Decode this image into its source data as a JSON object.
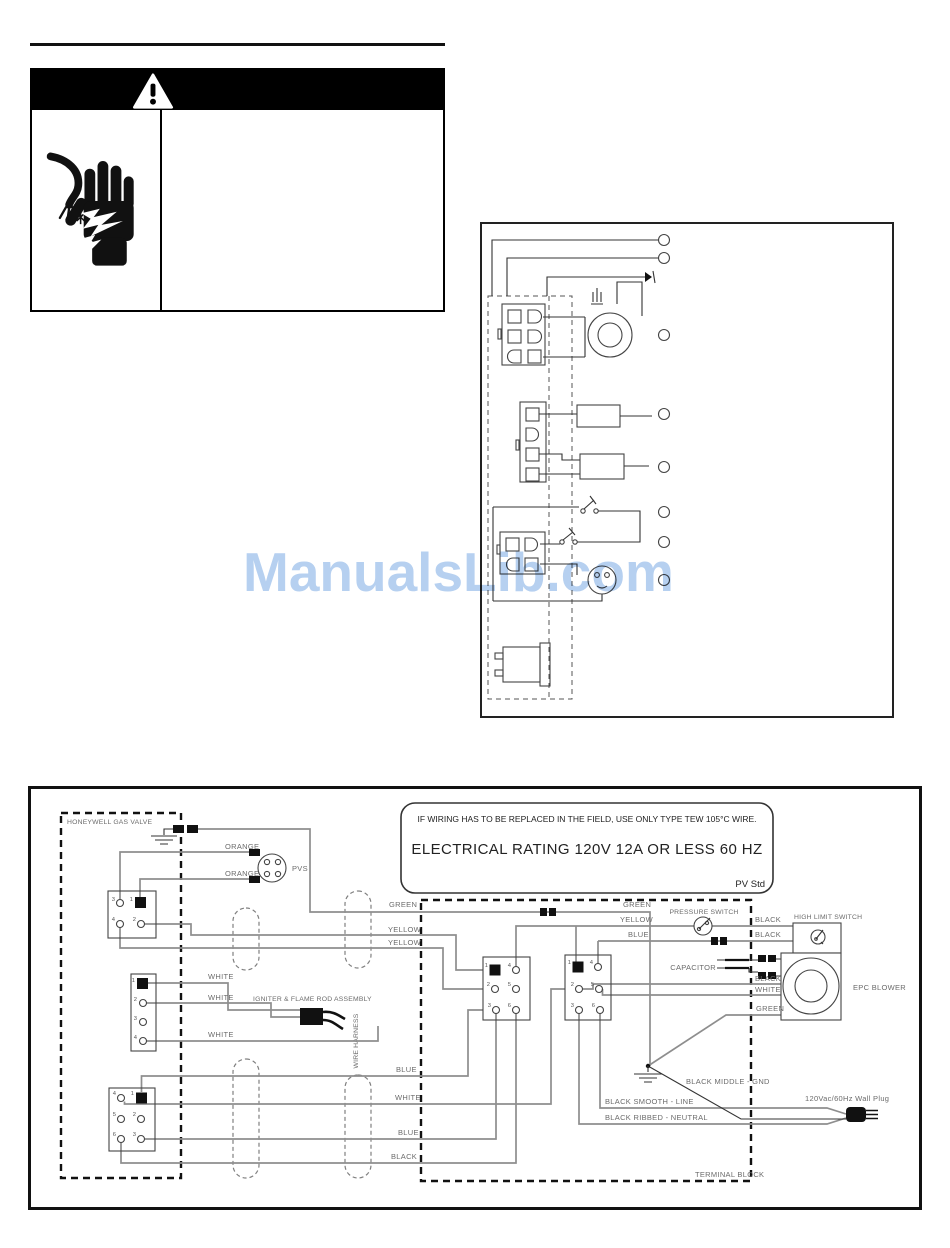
{
  "watermark": {
    "text": "ManualsLib.com",
    "color": "#b6d0f0"
  },
  "warning": {
    "header_icon": "warning-triangle",
    "left_icon": "electric-shock-hand"
  },
  "notice": {
    "line1": "IF WIRING HAS TO BE REPLACED IN THE FIELD, USE ONLY TYPE TEW 105°C WIRE.",
    "line2": "ELECTRICAL RATING 120V 12A OR LESS 60 HZ",
    "corner": "PV Std"
  },
  "labels": {
    "honeywell": "HONEYWELL GAS VALVE",
    "orange1": "ORANGE",
    "orange2": "ORANGE",
    "pvs": "PVS",
    "green_left": "GREEN",
    "yellow_left1": "YELLOW",
    "yellow_left2": "YELLOW",
    "green_tb": "GREEN",
    "yellow_tb": "YELLOW",
    "blue_tb": "BLUE",
    "pressure_switch": "PRESSURE SWITCH",
    "black_hl1": "BLACK",
    "black_hl2": "BLACK",
    "high_limit": "HIGH LIMIT SWITCH",
    "capacitor": "CAPACITOR",
    "black_blower": "BLACK",
    "white_blower": "WHITE",
    "green_blower": "GREEN",
    "epc_blower": "EPC BLOWER",
    "white1": "WHITE",
    "white2": "WHITE",
    "white3": "WHITE",
    "igniter": "IGNITER & FLAME ROD ASSEMBLY",
    "wire_harness": "WIRE HARNESS",
    "blue1": "BLUE",
    "white4": "WHITE",
    "blue2": "BLUE",
    "black4": "BLACK",
    "black_middle": "BLACK MIDDLE - GND",
    "black_smooth": "BLACK SMOOTH - LINE",
    "black_ribbed": "BLACK RIBBED - NEUTRAL",
    "wall_plug": "120Vac/60Hz Wall Plug",
    "terminal_block": "TERMINAL BLOCK"
  },
  "pins": {
    "gas_valve": [
      "3",
      "1",
      "4",
      "2"
    ],
    "igniter_conn": [
      "1",
      "2",
      "3",
      "4"
    ],
    "lower_left": [
      "4",
      "1",
      "5",
      "2",
      "6",
      "3"
    ],
    "tb_left": [
      "1",
      "4",
      "2",
      "5",
      "3",
      "6"
    ],
    "tb_right": [
      "1",
      "4",
      "2",
      "5",
      "3",
      "6"
    ]
  },
  "colors": {
    "watermark_blue": "#b6d0f0",
    "wire_gray": "#8e8e8e",
    "line_black": "#333333",
    "warning_header_bg": "#000000"
  }
}
